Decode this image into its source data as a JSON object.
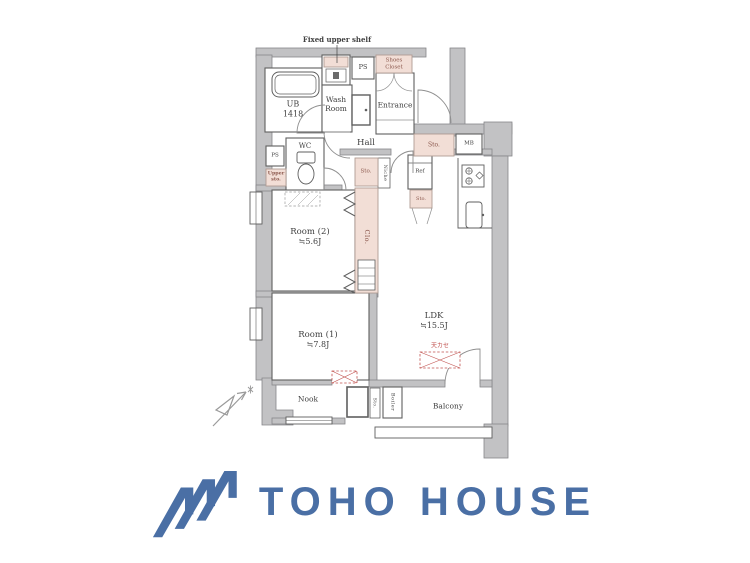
{
  "plan": {
    "labels": {
      "fixed_upper_shelf": "Fixed upper shelf",
      "ub1": "UB",
      "ub2": "1418",
      "wash1": "Wash",
      "wash2": "Room",
      "ps": "PS",
      "shoes1": "Shoes",
      "shoes2": "Closet",
      "entrance": "Entrance",
      "wc": "WC",
      "upper1": "Upper",
      "upper2": "sto.",
      "hall": "Hall",
      "sto": "Sto.",
      "niche": "Niche",
      "ref": "Ref",
      "mb": "MB",
      "clo": "Clo.",
      "tenkase": "天カセ",
      "nook": "Nook",
      "boiler": "Boiler",
      "balcony": "Balcony"
    },
    "rooms": {
      "room2": {
        "name": "Room (2)",
        "size": "≒5.6J"
      },
      "room1": {
        "name": "Room (1)",
        "size": "≒7.8J"
      },
      "ldk": {
        "name": "LDK",
        "size": "≒15.5J"
      }
    },
    "colors": {
      "wall_gray": "#c2c2c4",
      "storage_pink": "#f2ded6",
      "ac_red": "#c0504d",
      "line": "#5f5f5f"
    }
  },
  "logo": {
    "text": "TOHO HOUSE",
    "color": "#4a6fa5"
  }
}
